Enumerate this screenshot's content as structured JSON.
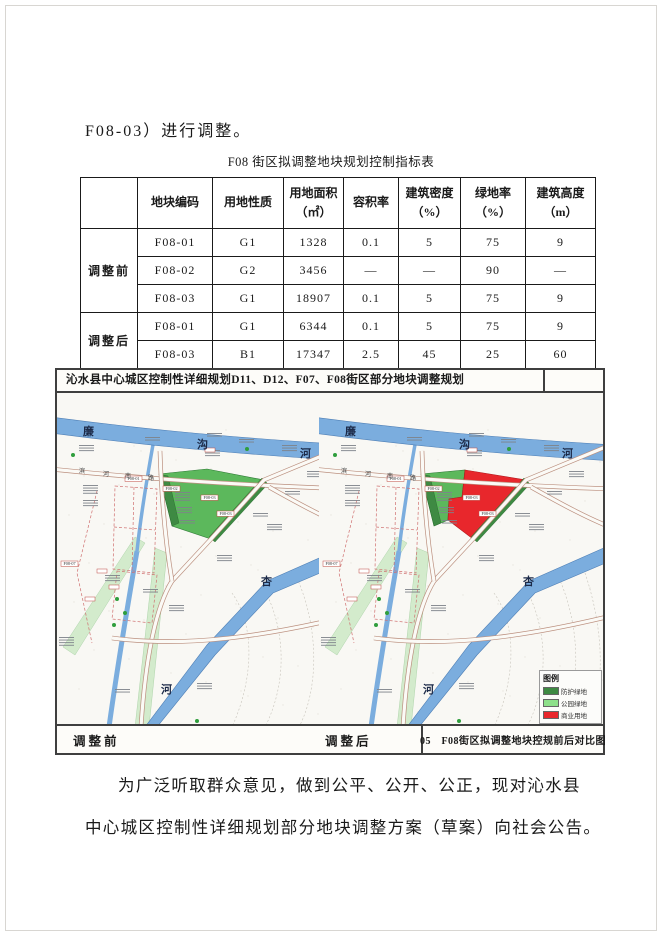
{
  "page": {
    "heading": "F08-03）进行调整。",
    "closing_lines": [
      "为广泛听取群众意见，做到公平、公开、公正，现对沁水县",
      "中心城区控制性详细规划部分地块调整方案（草案）向社会公告。"
    ]
  },
  "table": {
    "title": "F08 街区拟调整地块规划控制指标表",
    "columns": [
      "",
      "地块编码",
      "用地性质",
      "用地面积\n（㎡）",
      "容积率",
      "建筑密度\n（%）",
      "绿地率\n（%）",
      "建筑高度\n（m）"
    ],
    "groups": [
      {
        "label": "调整前",
        "rows": [
          {
            "code": "F08-01",
            "nature": "G1",
            "area": "1328",
            "far": "0.1",
            "density": "5",
            "green": "75",
            "height": "9"
          },
          {
            "code": "F08-02",
            "nature": "G2",
            "area": "3456",
            "far": "—",
            "density": "—",
            "green": "90",
            "height": "—"
          },
          {
            "code": "F08-03",
            "nature": "G1",
            "area": "18907",
            "far": "0.1",
            "density": "5",
            "green": "75",
            "height": "9"
          }
        ]
      },
      {
        "label": "调整后",
        "rows": [
          {
            "code": "F08-01",
            "nature": "G1",
            "area": "6344",
            "far": "0.1",
            "density": "5",
            "green": "75",
            "height": "9"
          },
          {
            "code": "F08-03",
            "nature": "B1",
            "area": "17347",
            "far": "2.5",
            "density": "45",
            "green": "25",
            "height": "60"
          }
        ]
      }
    ]
  },
  "maps": {
    "title": "沁水县中心城区控制性详细规划D11、D12、F07、F08街区部分地块调整规划",
    "caption": "05　F08街区拟调整地块控规前后对比图",
    "left": {
      "bottom_label": "调整前",
      "tags": [
        "F08-01",
        "F08-02",
        "F08-03",
        "F08-03",
        "F08-07"
      ]
    },
    "right": {
      "bottom_label": "调整后",
      "tags": [
        "F08-01",
        "F08-02",
        "F08-03",
        "F08-03",
        "F08-07"
      ]
    },
    "labels": {
      "river_top_chars": [
        "廉",
        "沟",
        "河"
      ],
      "road_chars": [
        "滨",
        "河",
        "南",
        "路"
      ],
      "river_bottom_chars": [
        "杏",
        "河"
      ]
    },
    "legend": {
      "title": "图例",
      "items": [
        {
          "label": "防护绿地",
          "color": "#3e8a43"
        },
        {
          "label": "公园绿地",
          "color": "#8de08a"
        },
        {
          "label": "商业用地",
          "color": "#e8272c"
        }
      ]
    }
  },
  "colors": {
    "park_green": "#5cb85c",
    "protective_green": "#3e8a43",
    "commercial_red": "#e8272c",
    "river_blue": "#7badde",
    "road_line": "#bb8f7e",
    "boundary_dashed_red": "#cf6f6f"
  }
}
